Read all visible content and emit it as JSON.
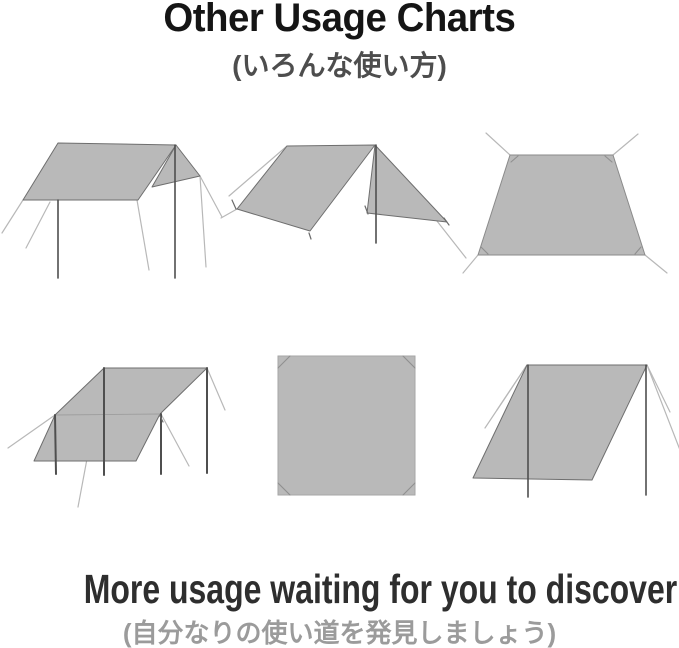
{
  "page": {
    "title": "Other Usage Charts",
    "subtitle_jp": "(いろんな使い方)",
    "footer_text": "More usage waiting for you to discover",
    "footer_jp": "(自分なりの使い道を発見しましょう)"
  },
  "colors": {
    "background": "#ffffff",
    "title": "#151515",
    "subtitle": "#4d4d4d",
    "footer": "#2e2e2e",
    "footer_jp": "#9b9b9b",
    "tarp_fill": "#b9b9b9",
    "tarp_outline": "#6e6e6e",
    "pole": "#4f4f4f",
    "guy_line": "#b8b8b8"
  },
  "diagrams": [
    {
      "name": "flat-tarp-with-side-flap-icon"
    },
    {
      "name": "a-frame-tarp-icon"
    },
    {
      "name": "ground-sheet-icon"
    },
    {
      "name": "four-pole-awning-icon"
    },
    {
      "name": "flat-square-tarp-icon"
    },
    {
      "name": "lean-to-tarp-icon"
    }
  ]
}
